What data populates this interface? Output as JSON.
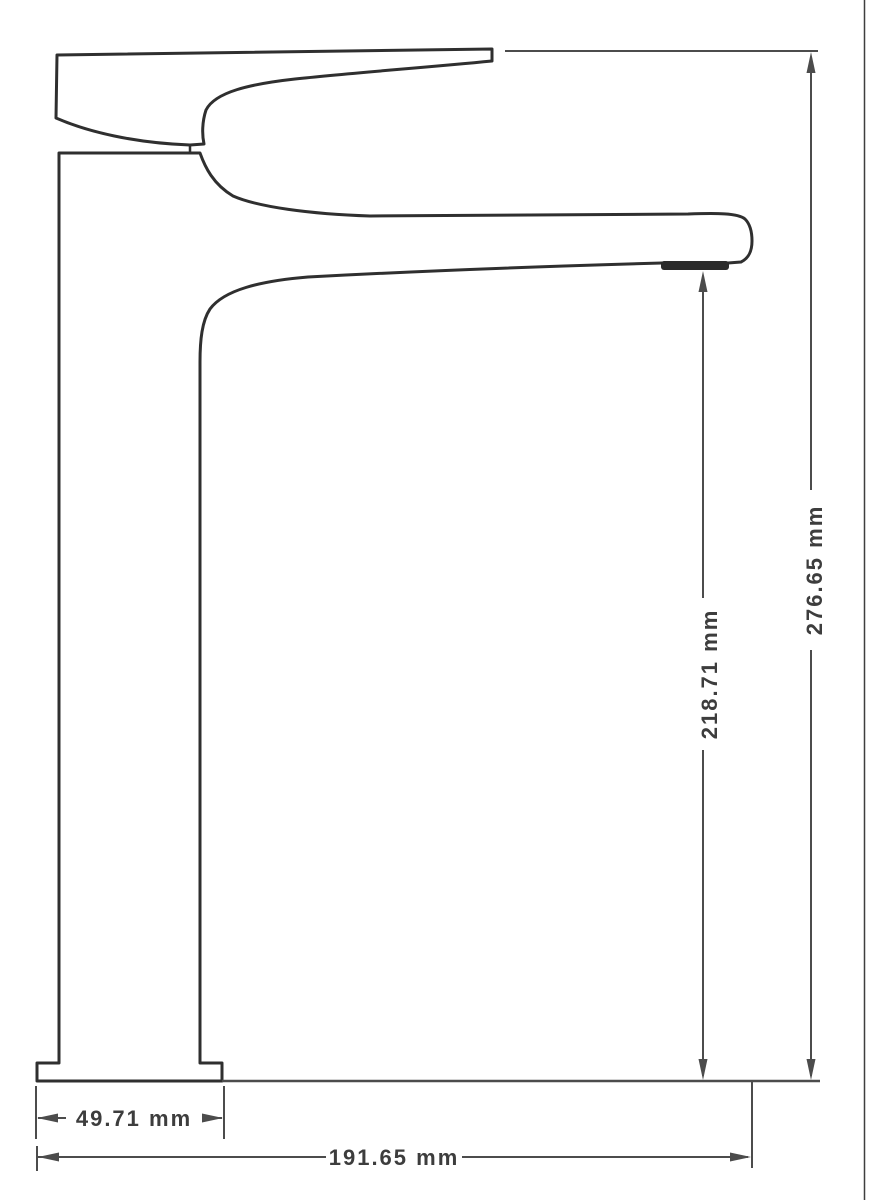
{
  "drawing": {
    "type": "technical-dimension-drawing",
    "subject": "single-lever tall basin faucet, side profile",
    "dimensions": {
      "total_height": {
        "label": "276.65 mm"
      },
      "spout_height": {
        "label": "218.71 mm"
      },
      "base_width": {
        "label": "49.71 mm"
      },
      "total_length": {
        "label": "191.65 mm"
      }
    },
    "colors": {
      "outline": "#2f2f2f",
      "dimension_lines": "#4c4c4c",
      "text": "#3d3d3d",
      "aerator_fill": "#2b2b2b",
      "background": "#ffffff",
      "border": "#3f3f3f"
    }
  }
}
